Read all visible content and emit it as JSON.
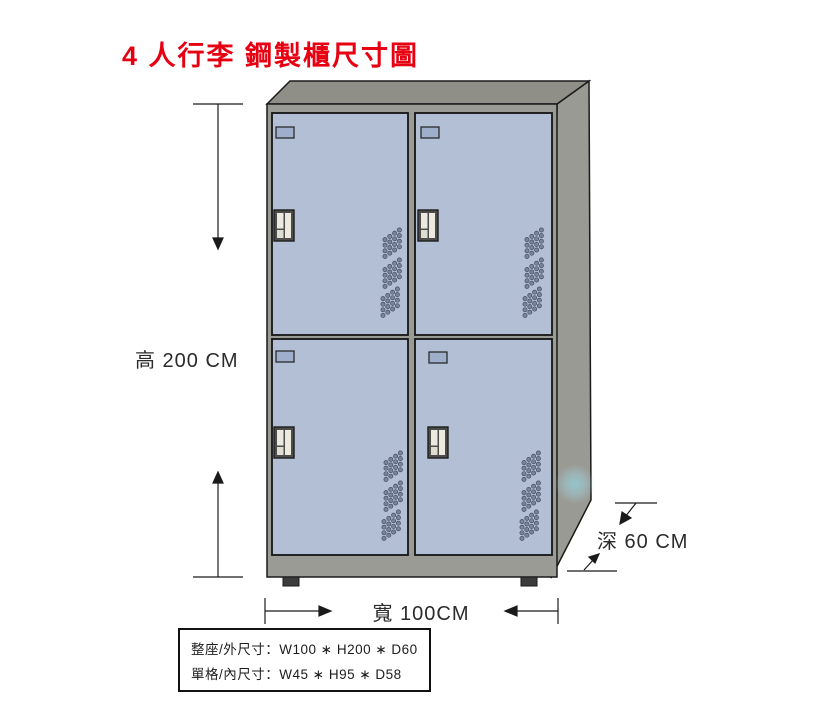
{
  "title": {
    "text": "4 人行李 鋼製櫃尺寸圖"
  },
  "dimensions": {
    "height_label": "高 200 CM",
    "width_label": "寬 100CM",
    "depth_label": "深 60 CM"
  },
  "spec_box": {
    "line1": "整座/外尺寸：W100 ∗ H200 ∗ D60",
    "line2": "單格/內尺寸：W45 ∗ H95 ∗ D58"
  },
  "cabinet": {
    "door_count": 4,
    "doors_per_row": 2
  },
  "colors": {
    "title_red": "#e60012",
    "door_blue_gray": "#b3bfd4",
    "cabinet_side_gray": "#9a9a94",
    "cabinet_top_gray": "#8f8f88",
    "front_frame_gray": "#9b9b95",
    "door_label_slot_blue": "#9dafca",
    "foot_dark": "#3c3c3c",
    "dimension_line": "#1a1a1a",
    "watermark_teal": "#8fd0d8"
  }
}
